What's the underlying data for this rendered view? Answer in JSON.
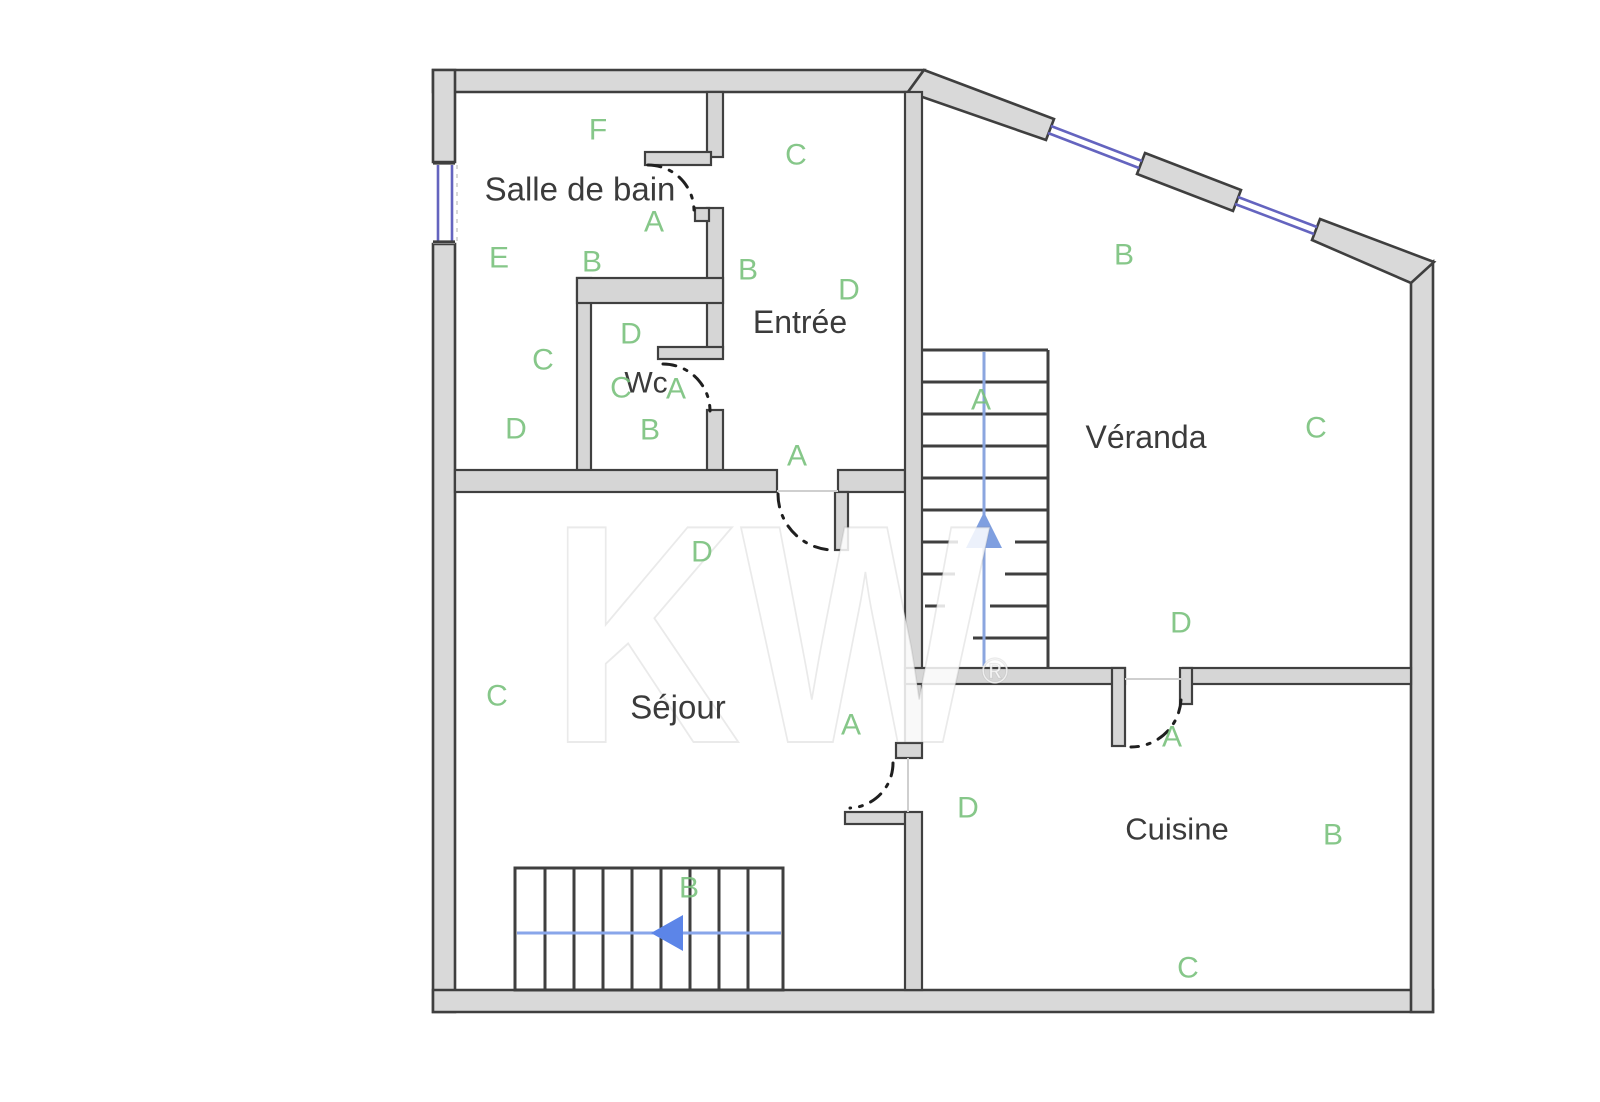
{
  "colors": {
    "background": "#ffffff",
    "wall_fill": "#d9d9d9",
    "wall_stroke": "#3f3f3f",
    "inner_wall_fill": "#d6d6d6",
    "inner_wall_stroke": "#404040",
    "light_line": "#cfcfcf",
    "door_arc": "#1f1f1f",
    "window_blue": "#6464bf",
    "stair_stroke": "#3f3f3f",
    "letter_green": "#79c17d",
    "room_text": "#3b3b3b",
    "watermark_fill": "rgba(255,255,255,0.85)",
    "watermark_stroke": "rgba(140,140,140,0.18)"
  },
  "watermark": {
    "text": "KW",
    "x": 775,
    "y": 742,
    "font_size": 312,
    "text_length": 440,
    "reg": "®",
    "reg_x": 995,
    "reg_y": 683,
    "reg_size": 36
  },
  "structure": {
    "outer_polygons": [
      {
        "id": "top-wall",
        "points": [
          [
            433,
            70
          ],
          [
            924,
            70
          ],
          [
            908,
            92
          ],
          [
            433,
            92
          ]
        ]
      },
      {
        "id": "left-wall-upper",
        "points": [
          [
            433,
            70
          ],
          [
            455,
            70
          ],
          [
            455,
            162
          ],
          [
            433,
            162
          ]
        ]
      },
      {
        "id": "left-wall-lower",
        "points": [
          [
            433,
            244
          ],
          [
            455,
            244
          ],
          [
            455,
            1012
          ],
          [
            433,
            1012
          ]
        ]
      },
      {
        "id": "bottom-wall",
        "points": [
          [
            433,
            990
          ],
          [
            1433,
            990
          ],
          [
            1433,
            1012
          ],
          [
            433,
            1012
          ]
        ]
      },
      {
        "id": "right-wall",
        "points": [
          [
            1411,
            282
          ],
          [
            1433,
            262
          ],
          [
            1433,
            1012
          ],
          [
            1411,
            1012
          ]
        ]
      },
      {
        "id": "diagonal-wall-a",
        "points": [
          [
            924,
            70
          ],
          [
            1054,
            119
          ],
          [
            1046,
            140
          ],
          [
            908,
            92
          ]
        ]
      },
      {
        "id": "diagonal-wall-b",
        "points": [
          [
            1145,
            153
          ],
          [
            1241,
            190
          ],
          [
            1233,
            211
          ],
          [
            1137,
            174
          ]
        ]
      },
      {
        "id": "diagonal-wall-c",
        "points": [
          [
            1320,
            219
          ],
          [
            1434,
            262
          ],
          [
            1411,
            283
          ],
          [
            1312,
            240
          ]
        ]
      }
    ],
    "inner_rects": [
      {
        "id": "bath-entry-wall-top",
        "r": [
          707,
          92,
          16,
          65
        ]
      },
      {
        "id": "bath-door-stub",
        "r": [
          645,
          152,
          66,
          13
        ]
      },
      {
        "id": "bath-entry-wall-mid",
        "r": [
          707,
          208,
          16,
          141
        ]
      },
      {
        "id": "bath-entry-wall-foot",
        "r": [
          695,
          208,
          14,
          13
        ]
      },
      {
        "id": "wc-door-stub",
        "r": [
          658,
          347,
          65,
          12
        ]
      },
      {
        "id": "bath-entry-wall-low",
        "r": [
          707,
          410,
          16,
          68
        ]
      },
      {
        "id": "wc-left-wall",
        "r": [
          577,
          278,
          14,
          194
        ]
      },
      {
        "id": "wc-top-wall",
        "r": [
          577,
          278,
          146,
          25
        ]
      },
      {
        "id": "sejour-top-wall-left",
        "r": [
          455,
          470,
          322,
          22
        ]
      },
      {
        "id": "sejour-top-wall-right",
        "r": [
          838,
          470,
          67,
          22
        ]
      },
      {
        "id": "sejour-door-stub",
        "r": [
          835,
          492,
          13,
          58
        ]
      },
      {
        "id": "center-wall-upper",
        "r": [
          905,
          92,
          17,
          651
        ]
      },
      {
        "id": "center-wall-hook",
        "r": [
          896,
          743,
          26,
          15
        ]
      },
      {
        "id": "cuisine-door-stub-west",
        "r": [
          845,
          812,
          62,
          12
        ]
      },
      {
        "id": "center-wall-lower",
        "r": [
          905,
          812,
          17,
          178
        ]
      },
      {
        "id": "veranda-cuisine-wall-left",
        "r": [
          905,
          668,
          220,
          16
        ]
      },
      {
        "id": "cuisine-door-stub-left",
        "r": [
          1112,
          668,
          13,
          78
        ]
      },
      {
        "id": "veranda-cuisine-wall-right",
        "r": [
          1183,
          668,
          228,
          16
        ]
      },
      {
        "id": "cuisine-door-stub-right",
        "r": [
          1180,
          668,
          12,
          36
        ]
      }
    ],
    "light_lines": [
      [
        777,
        491,
        838,
        491
      ],
      [
        908,
        758,
        908,
        812
      ],
      [
        1125,
        679,
        1183,
        679
      ]
    ],
    "window_ghost_line": [
      457,
      165,
      457,
      241
    ]
  },
  "doors": [
    {
      "id": "salle-de-bain-door",
      "path": "M648,165 A46,46 0 0 1 694,210"
    },
    {
      "id": "wc-door",
      "path": "M663,364 A47,47 0 0 1 710,411"
    },
    {
      "id": "sejour-door",
      "path": "M778,494 A56,56 0 0 0 834,550"
    },
    {
      "id": "sejour-cuisine-door",
      "path": "M893,763 A45,45 0 0 1 850,808"
    },
    {
      "id": "cuisine-door",
      "path": "M1181,700 A50,50 0 0 1 1131,747"
    }
  ],
  "windows": {
    "gap_rects": [
      [
        433,
        162,
        22,
        82
      ]
    ],
    "panes": [
      [
        438,
        165,
        438,
        241
      ],
      [
        452,
        165,
        452,
        241
      ],
      [
        1051,
        126,
        1142,
        161
      ],
      [
        1048,
        133,
        1139,
        168
      ],
      [
        1238,
        197,
        1317,
        227
      ],
      [
        1235,
        204,
        1314,
        234
      ]
    ],
    "caps": [
      [
        433,
        163,
        455,
        163
      ],
      [
        433,
        242,
        455,
        242
      ]
    ]
  },
  "stairs": [
    {
      "id": "veranda-stairs",
      "outline_lines": [
        [
          922,
          350,
          1048,
          350
        ],
        [
          1048,
          350,
          1048,
          668
        ]
      ],
      "treads": [
        [
          922,
          382,
          1048,
          382
        ],
        [
          922,
          414,
          1048,
          414
        ],
        [
          922,
          446,
          1048,
          446
        ],
        [
          922,
          478,
          1048,
          478
        ],
        [
          922,
          510,
          1048,
          510
        ]
      ],
      "partial_treads": [
        [
          922,
          542,
          958,
          542
        ],
        [
          1015,
          542,
          1048,
          542
        ],
        [
          922,
          574,
          955,
          574
        ],
        [
          1005,
          574,
          1048,
          574
        ],
        [
          925,
          606,
          945,
          606
        ],
        [
          990,
          606,
          1048,
          606
        ],
        [
          973,
          638,
          1048,
          638
        ]
      ],
      "direction_line": [
        984,
        352,
        984,
        666
      ],
      "line_color": "#8ba6df",
      "arrow": [
        [
          984,
          512
        ],
        [
          966,
          548
        ],
        [
          1002,
          548
        ]
      ],
      "arrow_color": "#7f9fe0"
    },
    {
      "id": "sejour-stairs",
      "outline_rect": [
        515,
        868,
        268,
        122
      ],
      "treads": [
        [
          545,
          868,
          545,
          990
        ],
        [
          574,
          868,
          574,
          990
        ],
        [
          603,
          868,
          603,
          990
        ],
        [
          632,
          868,
          632,
          990
        ],
        [
          661,
          868,
          661,
          990
        ],
        [
          690,
          868,
          690,
          990
        ],
        [
          719,
          868,
          719,
          990
        ],
        [
          748,
          868,
          748,
          990
        ]
      ],
      "partial_treads": [],
      "direction_line": [
        517,
        933,
        781,
        933
      ],
      "line_color": "#89a6ea",
      "arrow": [
        [
          651,
          933
        ],
        [
          683,
          915
        ],
        [
          683,
          951
        ]
      ],
      "arrow_color": "#5c85e8"
    }
  ],
  "rooms": [
    {
      "name": "Salle de bain",
      "x": 580,
      "y": 189,
      "fs": 33
    },
    {
      "name": "Wc",
      "x": 646,
      "y": 383,
      "fs": 30
    },
    {
      "name": "Entrée",
      "x": 800,
      "y": 322,
      "fs": 32
    },
    {
      "name": "Séjour",
      "x": 678,
      "y": 707,
      "fs": 33
    },
    {
      "name": "Véranda",
      "x": 1146,
      "y": 437,
      "fs": 32
    },
    {
      "name": "Cuisine",
      "x": 1177,
      "y": 829,
      "fs": 31
    }
  ],
  "letters": [
    {
      "t": "F",
      "x": 598,
      "y": 130
    },
    {
      "t": "A",
      "x": 654,
      "y": 222
    },
    {
      "t": "E",
      "x": 499,
      "y": 258
    },
    {
      "t": "B",
      "x": 592,
      "y": 262
    },
    {
      "t": "C",
      "x": 543,
      "y": 360
    },
    {
      "t": "D",
      "x": 516,
      "y": 429
    },
    {
      "t": "D",
      "x": 631,
      "y": 334
    },
    {
      "t": "C",
      "x": 621,
      "y": 388
    },
    {
      "t": "A",
      "x": 676,
      "y": 389
    },
    {
      "t": "B",
      "x": 650,
      "y": 430
    },
    {
      "t": "C",
      "x": 796,
      "y": 155
    },
    {
      "t": "B",
      "x": 748,
      "y": 270
    },
    {
      "t": "D",
      "x": 849,
      "y": 290
    },
    {
      "t": "A",
      "x": 797,
      "y": 456
    },
    {
      "t": "D",
      "x": 702,
      "y": 552
    },
    {
      "t": "C",
      "x": 497,
      "y": 696
    },
    {
      "t": "A",
      "x": 851,
      "y": 725
    },
    {
      "t": "B",
      "x": 689,
      "y": 888
    },
    {
      "t": "B",
      "x": 1124,
      "y": 255
    },
    {
      "t": "A",
      "x": 981,
      "y": 400
    },
    {
      "t": "C",
      "x": 1316,
      "y": 428
    },
    {
      "t": "D",
      "x": 1181,
      "y": 623
    },
    {
      "t": "A",
      "x": 1172,
      "y": 737
    },
    {
      "t": "D",
      "x": 968,
      "y": 808
    },
    {
      "t": "B",
      "x": 1333,
      "y": 835
    },
    {
      "t": "C",
      "x": 1188,
      "y": 968
    }
  ]
}
